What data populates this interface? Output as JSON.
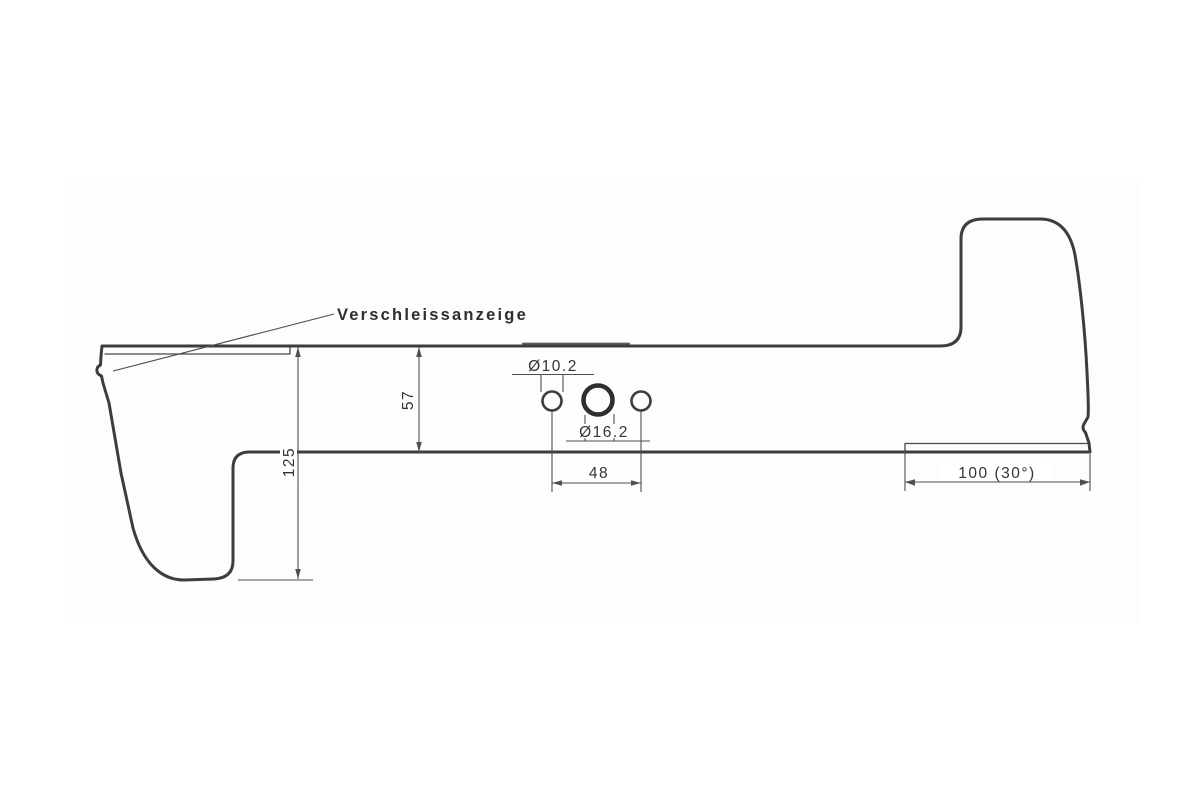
{
  "drawing": {
    "labels": {
      "wear_indicator": "Verschleissanzeige"
    },
    "dimensions": {
      "side_hole_diameter": "Ø10.2",
      "center_hole_diameter": "Ø16.2",
      "blade_width": "57",
      "left_end_width": "125",
      "hole_spacing": "48",
      "cutting_edge_length": "100 (30°)"
    },
    "colors": {
      "outline": "#3d3d3d",
      "dimension_lines": "#4f4f4f",
      "text": "#333333",
      "background": "#ffffff"
    }
  }
}
